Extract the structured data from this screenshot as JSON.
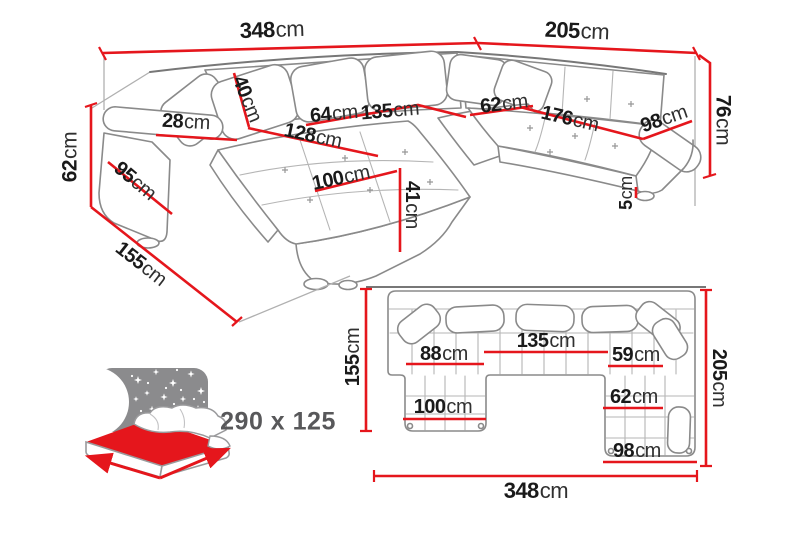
{
  "colors": {
    "dimension_line": "#e5161c",
    "sketch_line": "#8a8a8a",
    "label_digits": "#1a1a1a",
    "label_unit": "#303030",
    "icon_panel_gray": "#8b8b8d",
    "sleeping_text_gray": "#58585a",
    "background": "#ffffff"
  },
  "perspective_view": {
    "dimensions": {
      "back_width_left": {
        "value": "348",
        "unit": "cm"
      },
      "back_width_right": {
        "value": "205",
        "unit": "cm"
      },
      "back_height": {
        "value": "76",
        "unit": "cm"
      },
      "armrest_height": {
        "value": "62",
        "unit": "cm"
      },
      "armrest_top_width": {
        "value": "28",
        "unit": "cm"
      },
      "armrest_depth": {
        "value": "95",
        "unit": "cm"
      },
      "chaise_side_depth": {
        "value": "155",
        "unit": "cm"
      },
      "back_cushion_height": {
        "value": "40",
        "unit": "cm"
      },
      "seat_depth_left": {
        "value": "64",
        "unit": "cm"
      },
      "seat_width_left": {
        "value": "135",
        "unit": "cm"
      },
      "chaise_length": {
        "value": "128",
        "unit": "cm"
      },
      "chaise_width": {
        "value": "100",
        "unit": "cm"
      },
      "seat_height": {
        "value": "41",
        "unit": "cm"
      },
      "corner_seat_depth": {
        "value": "62",
        "unit": "cm"
      },
      "bench_length": {
        "value": "176",
        "unit": "cm"
      },
      "bench_width": {
        "value": "98",
        "unit": "cm"
      },
      "leg_height": {
        "value": "5",
        "unit": "cm"
      }
    }
  },
  "plan_view": {
    "dimensions": {
      "left_side": {
        "value": "155",
        "unit": "cm"
      },
      "left_seat": {
        "value": "88",
        "unit": "cm"
      },
      "middle_seat": {
        "value": "135",
        "unit": "cm"
      },
      "right_seat": {
        "value": "59",
        "unit": "cm"
      },
      "right_side": {
        "value": "205",
        "unit": "cm"
      },
      "chaise_width": {
        "value": "100",
        "unit": "cm"
      },
      "corner_depth": {
        "value": "62",
        "unit": "cm"
      },
      "corner_width": {
        "value": "98",
        "unit": "cm"
      },
      "total_width": {
        "value": "348",
        "unit": "cm"
      }
    }
  },
  "sleeping_area": {
    "label": "290 x 125"
  }
}
